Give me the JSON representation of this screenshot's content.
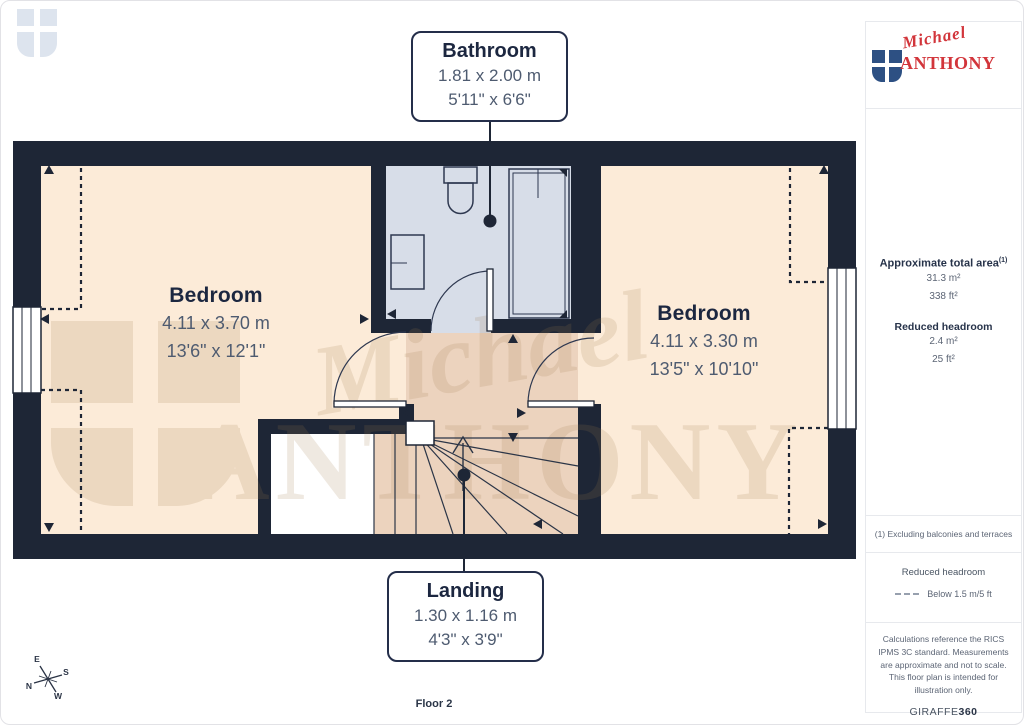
{
  "page": {
    "floor_label": "Floor 2"
  },
  "brand": {
    "script": "Michael",
    "word": "ANTHONY",
    "red": "#d2353b",
    "blue": "#2d5083"
  },
  "watermark": {
    "script": "Michael",
    "word": "ANTHONY"
  },
  "rooms": [
    {
      "name": "Bathroom",
      "metric": "1.81 x 2.00 m",
      "imperial": "5'11\" x 6'6\""
    },
    {
      "name": "Bedroom",
      "metric": "4.11 x 3.70 m",
      "imperial": "13'6\" x 12'1\""
    },
    {
      "name": "Bedroom",
      "metric": "4.11 x 3.30 m",
      "imperial": "13'5\" x 10'10\""
    },
    {
      "name": "Landing",
      "metric": "1.30 x 1.16 m",
      "imperial": "4'3\" x 3'9\""
    }
  ],
  "sidebar": {
    "area": {
      "title": "Approximate total area",
      "sup": "(1)",
      "metric": "31.3 m²",
      "imperial": "338 ft²"
    },
    "reduced": {
      "title": "Reduced headroom",
      "metric": "2.4 m²",
      "imperial": "25 ft²"
    },
    "footnote": "(1) Excluding balconies and terraces",
    "legend": {
      "title": "Reduced headroom",
      "label": "Below 1.5 m/5 ft"
    },
    "disclaimer": "Calculations reference the RICS IPMS 3C standard. Measurements are approximate and not to scale. This floor plan is intended for illustration only.",
    "vendor": {
      "name": "GIRAFFE",
      "suffix": "360"
    }
  },
  "compass": {
    "n": "N",
    "e": "E",
    "s": "S",
    "w": "W"
  },
  "plan_colors": {
    "wall": "#1e2636",
    "room": "#fcebd8",
    "landing": "#ecd3be",
    "bathroom": "#d7dde8"
  }
}
